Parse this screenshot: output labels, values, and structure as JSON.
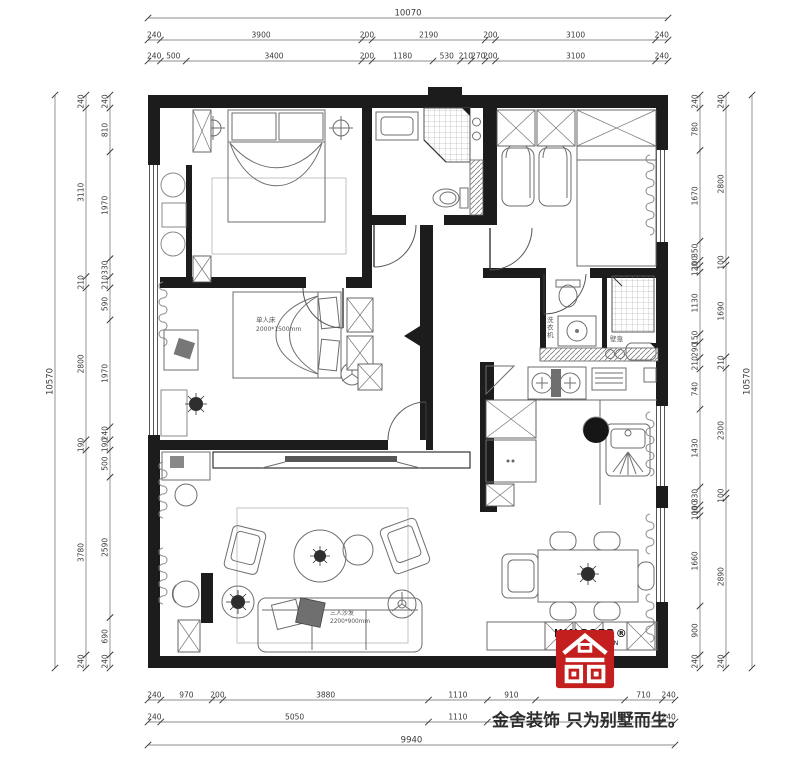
{
  "branding": {
    "logo_line1": "KINGSER®",
    "logo_line2": "DECORATION",
    "tagline": "金舍装饰 只为别墅而生。",
    "logo_color": "#c41f1f"
  },
  "labels": {
    "bed2_name": "单人床",
    "bed2_size": "2000*1500mm",
    "sofa_name": "三人沙发",
    "sofa_size": "2200*900mm",
    "washer": "洗衣机",
    "niche": "壁龛"
  },
  "dims": {
    "top_overall": "10070",
    "top_row2": [
      240,
      3900,
      200,
      2190,
      200,
      3100,
      240
    ],
    "top_row3": [
      240,
      500,
      3400,
      200,
      1180,
      530,
      210,
      270,
      200,
      3100,
      240
    ],
    "bottom_row1": [
      240,
      970,
      200,
      3880,
      1110,
      910,
      {
        "mm": 1680,
        "t": ""
      },
      710,
      240
    ],
    "bottom_row2": [
      240,
      5050,
      1110,
      {
        "mm": 3300,
        "t": ""
      },
      240
    ],
    "bottom_overall": "9940",
    "left_overall": "10570",
    "left_col2": [
      240,
      3110,
      210,
      2800,
      190,
      3780,
      240
    ],
    "left_col3": [
      240,
      810,
      1970,
      330,
      210,
      590,
      1970,
      240,
      190,
      500,
      2590,
      690,
      240
    ],
    "right_col1": [
      240,
      780,
      1670,
      350,
      100,
      120,
      1130,
      150,
      290,
      210,
      740,
      1430,
      330,
      100,
      100,
      1660,
      900,
      240
    ],
    "right_col2": [
      240,
      2800,
      100,
      1690,
      210,
      2300,
      100,
      2890,
      240
    ],
    "right_overall": "10570"
  }
}
